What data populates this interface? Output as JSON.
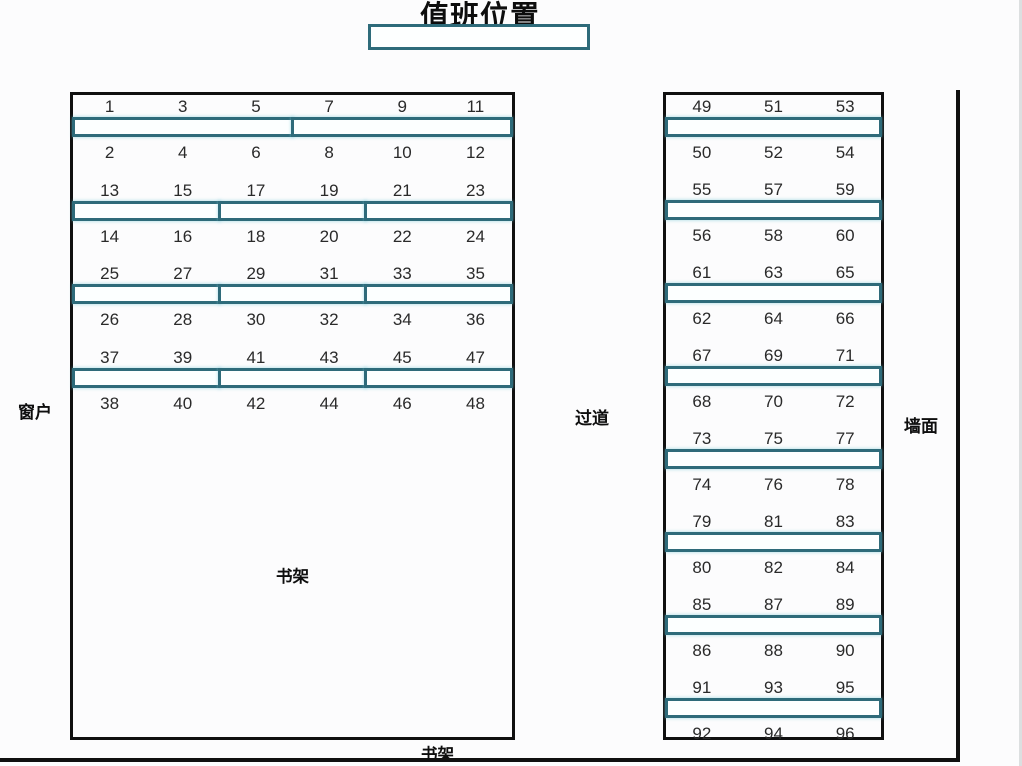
{
  "title": "值班位置",
  "duty_box": {
    "value": ""
  },
  "labels": {
    "window": "窗户",
    "aisle": "过道",
    "wall": "墙面",
    "bookshelf_inner": "书架",
    "bookshelf_bottom": "书架"
  },
  "colors": {
    "desk_teal": "#2e6b7a",
    "wall_black": "#101010",
    "paper": "#fcfcfd"
  },
  "seat_map": {
    "left_block": {
      "columns": 6,
      "pairs": [
        {
          "top": [
            "1",
            "3",
            "5",
            "7",
            "9",
            "11"
          ],
          "bottom": [
            "2",
            "4",
            "6",
            "8",
            "10",
            "12"
          ],
          "desk_segments": 2
        },
        {
          "top": [
            "13",
            "15",
            "17",
            "19",
            "21",
            "23"
          ],
          "bottom": [
            "14",
            "16",
            "18",
            "20",
            "22",
            "24"
          ],
          "desk_segments": 3
        },
        {
          "top": [
            "25",
            "27",
            "29",
            "31",
            "33",
            "35"
          ],
          "bottom": [
            "26",
            "28",
            "30",
            "32",
            "34",
            "36"
          ],
          "desk_segments": 3
        },
        {
          "top": [
            "37",
            "39",
            "41",
            "43",
            "45",
            "47"
          ],
          "bottom": [
            "38",
            "40",
            "42",
            "44",
            "46",
            "48"
          ],
          "desk_segments": 3
        }
      ]
    },
    "right_block": {
      "columns": 3,
      "pairs": [
        {
          "top": [
            "49",
            "51",
            "53"
          ],
          "bottom": [
            "50",
            "52",
            "54"
          ],
          "desk_segments": 1
        },
        {
          "top": [
            "55",
            "57",
            "59"
          ],
          "bottom": [
            "56",
            "58",
            "60"
          ],
          "desk_segments": 1
        },
        {
          "top": [
            "61",
            "63",
            "65"
          ],
          "bottom": [
            "62",
            "64",
            "66"
          ],
          "desk_segments": 1
        },
        {
          "top": [
            "67",
            "69",
            "71"
          ],
          "bottom": [
            "68",
            "70",
            "72"
          ],
          "desk_segments": 1
        },
        {
          "top": [
            "73",
            "75",
            "77"
          ],
          "bottom": [
            "74",
            "76",
            "78"
          ],
          "desk_segments": 1
        },
        {
          "top": [
            "79",
            "81",
            "83"
          ],
          "bottom": [
            "80",
            "82",
            "84"
          ],
          "desk_segments": 1
        },
        {
          "top": [
            "85",
            "87",
            "89"
          ],
          "bottom": [
            "86",
            "88",
            "90"
          ],
          "desk_segments": 1
        },
        {
          "top": [
            "91",
            "93",
            "95"
          ],
          "bottom": [
            "92",
            "94",
            "96"
          ],
          "desk_segments": 1
        }
      ]
    }
  }
}
